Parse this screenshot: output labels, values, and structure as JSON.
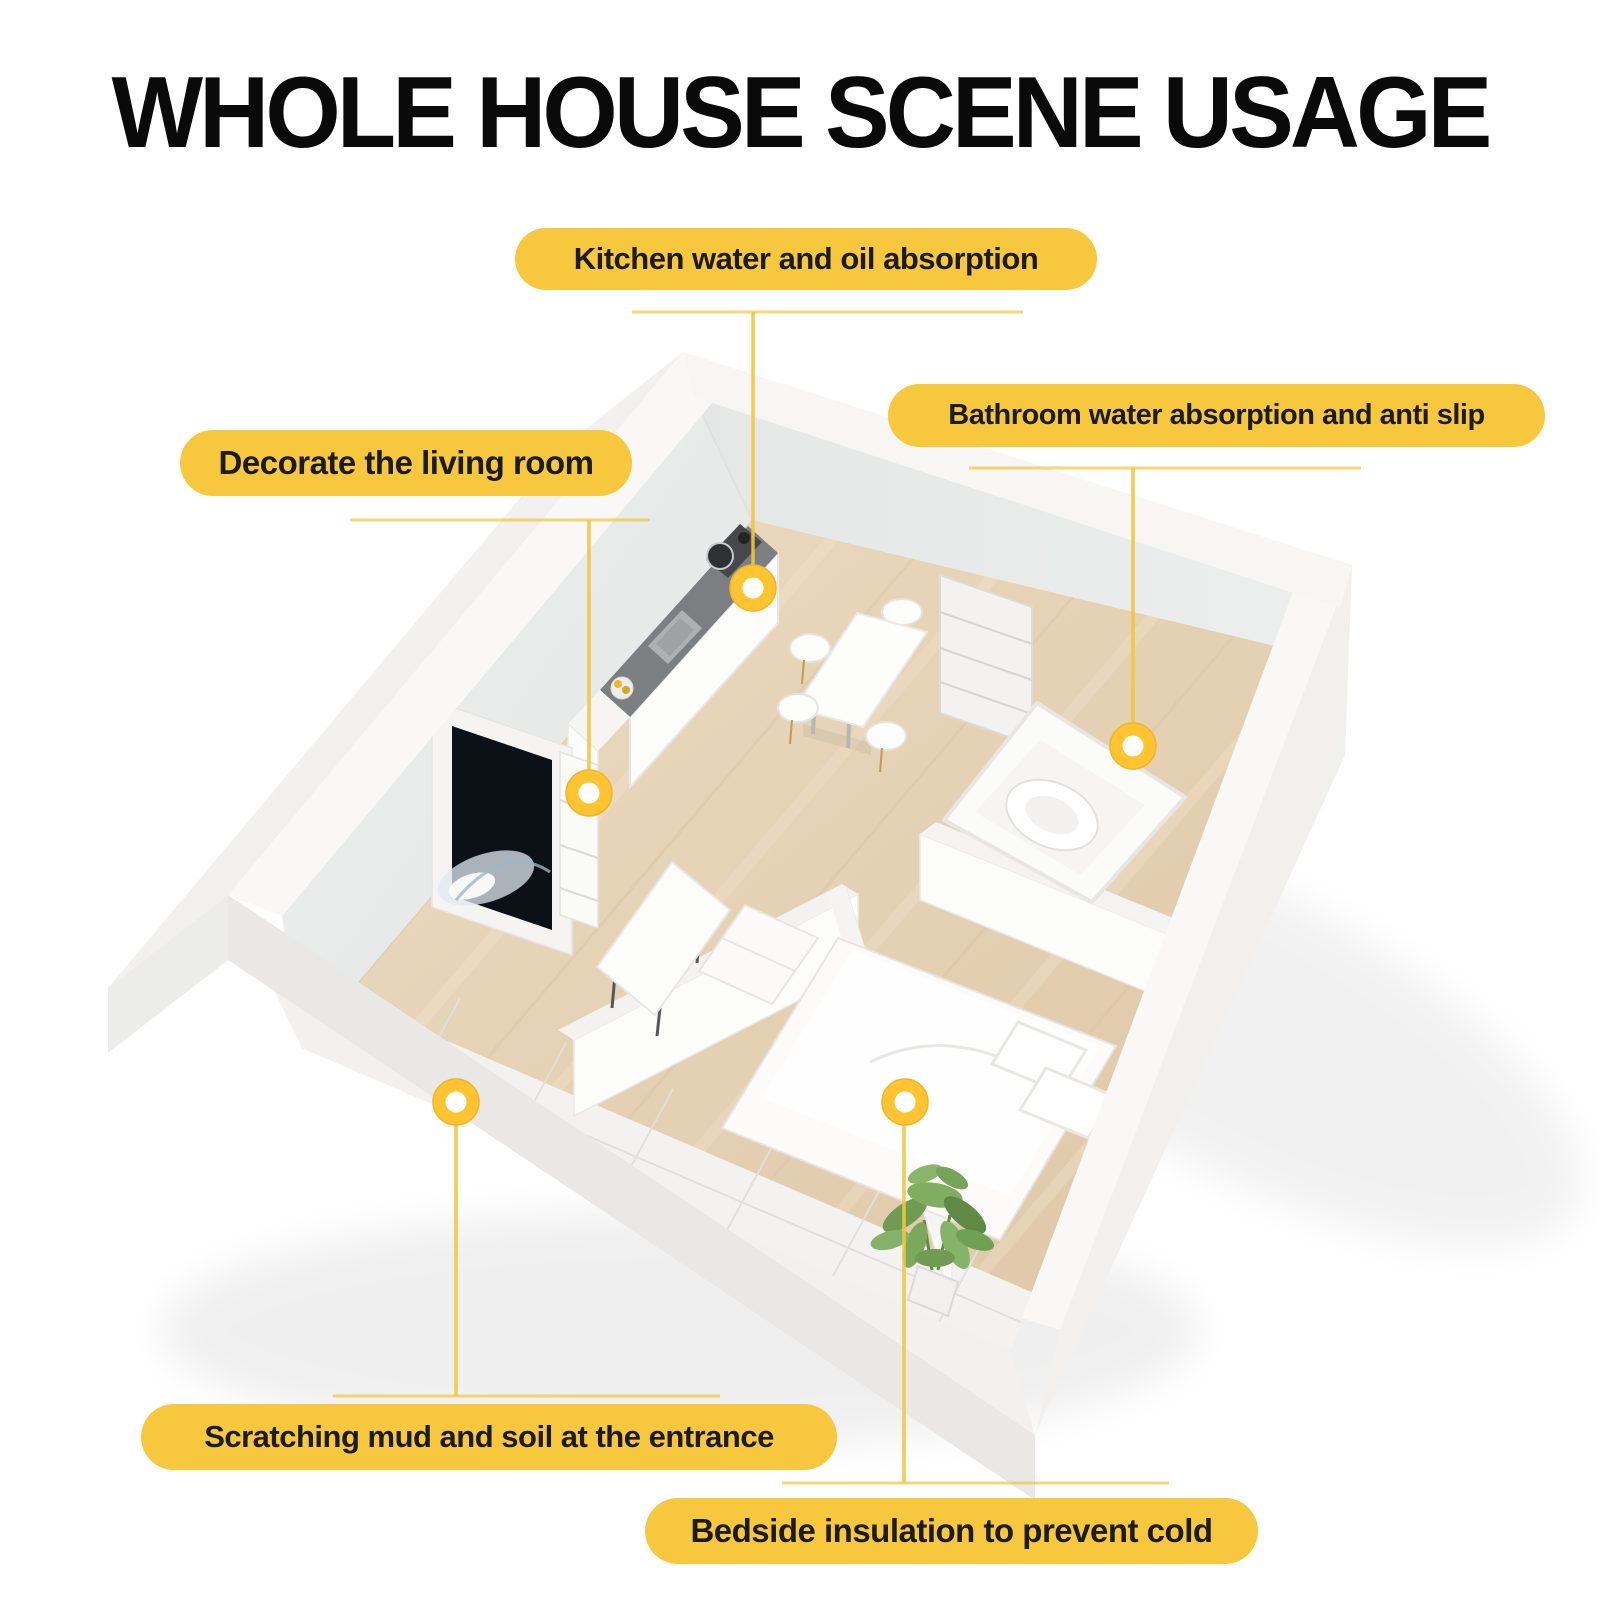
{
  "title": {
    "text": "WHOLE HOUSE SCENE USAGE"
  },
  "callouts": [
    {
      "id": "kitchen",
      "label": "Kitchen water and oil absorption",
      "target": "kitchen counter"
    },
    {
      "id": "bathroom",
      "label": "Bathroom water absorption and anti slip",
      "target": "bathroom floor"
    },
    {
      "id": "living",
      "label": "Decorate the living room",
      "target": "living room tv wall"
    },
    {
      "id": "entrance",
      "label": "Scratching mud and soil at the entrance",
      "target": "entrance tiles"
    },
    {
      "id": "bedside",
      "label": "Bedside insulation to prevent cold",
      "target": "bedside floor"
    }
  ],
  "colors": {
    "pill_yellow": "#F7C83E",
    "line_yellow": "#F2C53C",
    "marker_ring_yellow": "#FFC42F",
    "marker_center": "#FFFFFF",
    "title_black": "#0A0A0A",
    "wall_inner_gray": "#E8EBEA",
    "wall_white": "#F8F7F5",
    "wood_floor": "#E7D5B9",
    "entrance_tile": "#F4F2F0",
    "plant_green": "#7FAE60",
    "background": "#FFFFFF"
  },
  "scene": {
    "kind": "isometric cutaway apartment floor plan",
    "rooms": [
      "kitchen",
      "dining area",
      "living room",
      "bathroom",
      "bedroom",
      "entrance hallway"
    ],
    "furniture": [
      "kitchen counter with stove and sink",
      "tv wall unit",
      "dining table with chairs",
      "shelf unit",
      "bathtub with toilet",
      "double bed with pillows",
      "coffee table",
      "seat",
      "potted plant"
    ]
  }
}
